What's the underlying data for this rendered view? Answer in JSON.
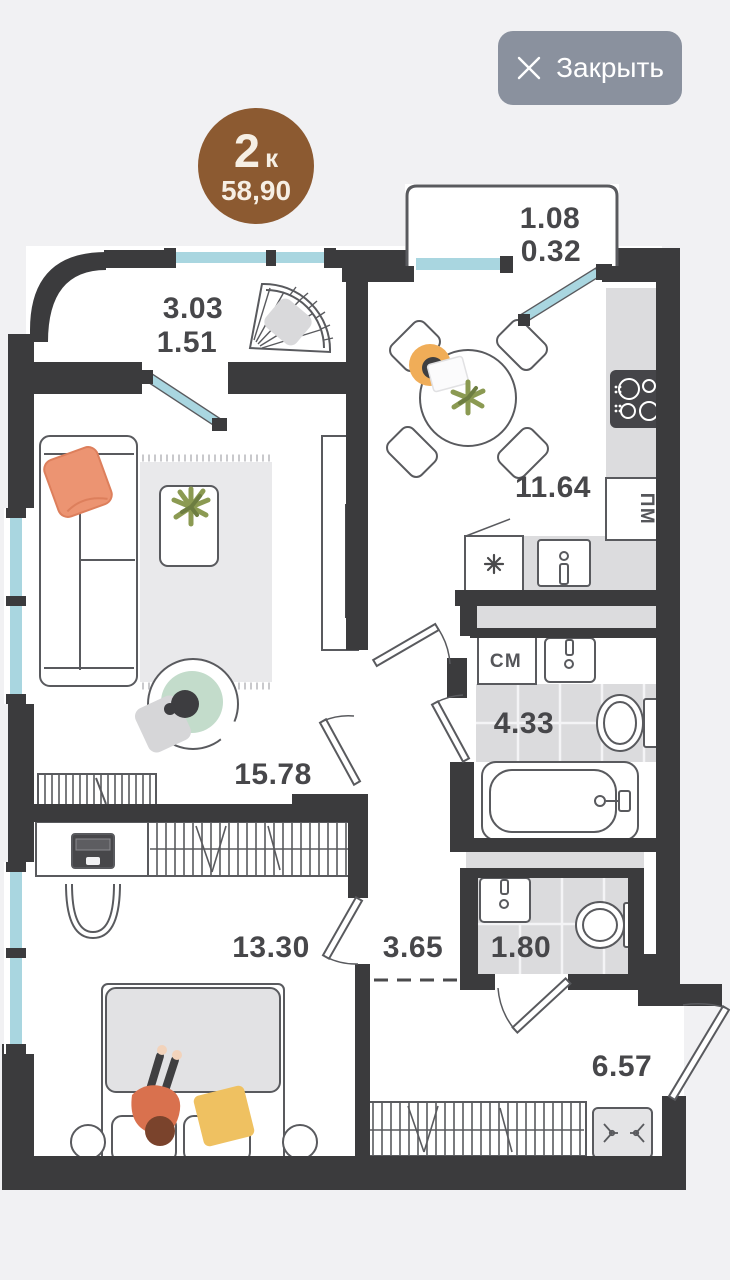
{
  "close_button": {
    "label": "Закрыть",
    "icon": "close-icon"
  },
  "badge": {
    "rooms": "2",
    "suffix": "к",
    "area": "58,90"
  },
  "plan": {
    "labels": {
      "balcony_left_line1": "3.03",
      "balcony_left_line2": "1.51",
      "balcony_top_line1": "1.08",
      "balcony_top_line2": "0.32",
      "kitchen": "11.64",
      "living_room": "15.78",
      "bathroom": "4.33",
      "bedroom": "13.30",
      "hallway": "3.65",
      "wc": "1.80",
      "corridor": "6.57",
      "dishwasher": "ПМ",
      "washing_machine": "СМ"
    },
    "colors": {
      "wall": "#3b3b3d",
      "window": "#a9d6e0",
      "badge_brown": "#8c5a31",
      "button_gray": "#8a919e",
      "accent_orange": "#ec9472",
      "accent_yellow": "#efc161",
      "accent_green": "#8b9a52",
      "accent_mint": "#c3dccb"
    }
  }
}
